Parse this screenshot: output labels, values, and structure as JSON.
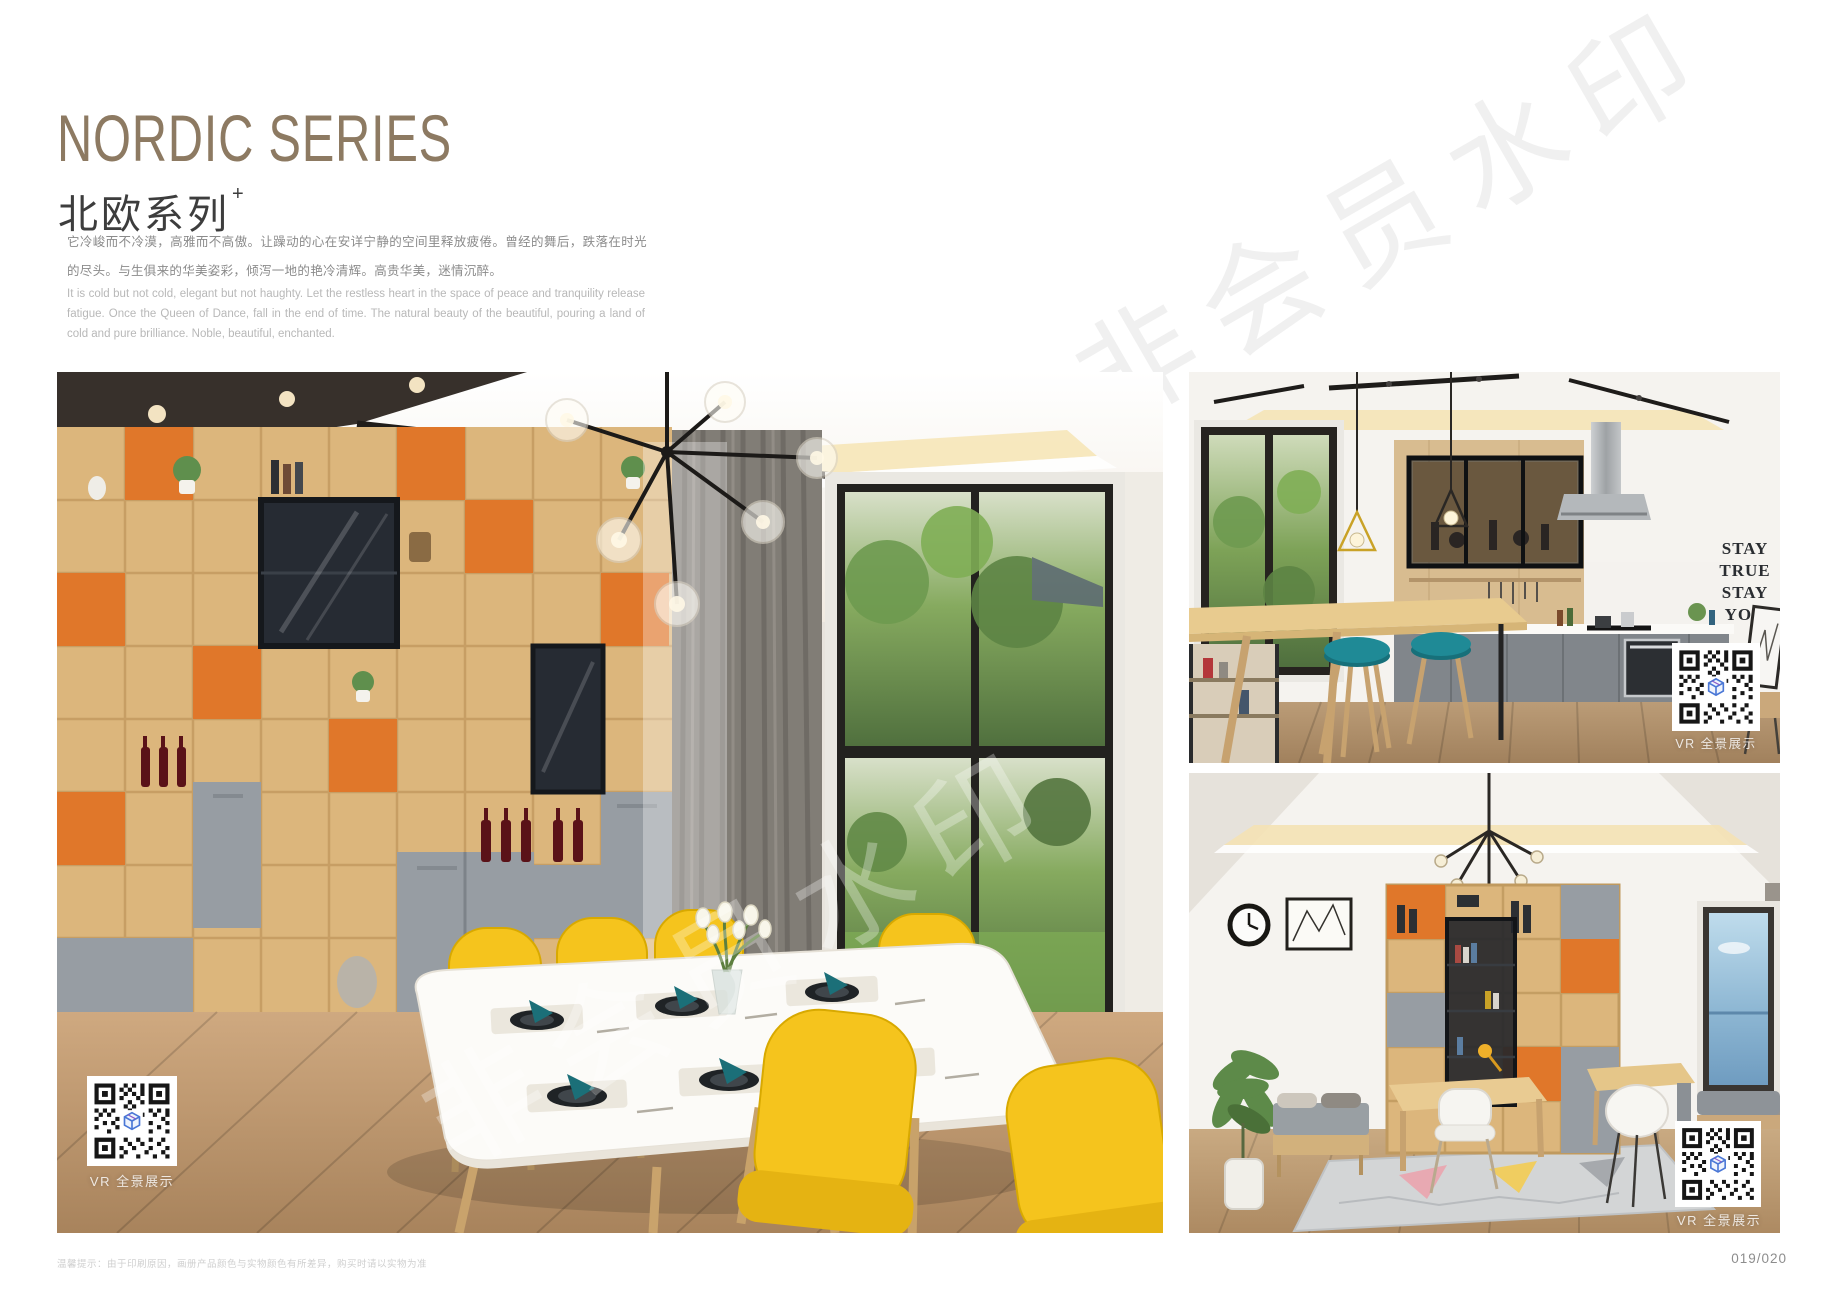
{
  "page": {
    "title_en": "NORDIC SERIES",
    "title_cn": "北欧系列",
    "title_superscript": "+",
    "description_cn": "它冷峻而不冷漠，高雅而不高傲。让躁动的心在安详宁静的空间里释放疲倦。曾经的舞后，跌落在时光的尽头。与生俱来的华美姿彩，倾泻一地的艳冷清辉。高贵华美，迷情沉醉。",
    "description_en": "It is cold but not cold, elegant but not haughty. Let the restless heart in the space of peace and tranquility release fatigue. Once the Queen of Dance, fall in the end of time. The natural beauty of the beautiful, pouring a land of cold and pure brilliance. Noble, beautiful, enchanted.",
    "watermark": "非会员水印",
    "footer_note": "温馨提示：由于印刷原因，画册产品颜色与实物颜色有所差异，购买时请以实物为准",
    "page_number": "019/020"
  },
  "photos": {
    "dining": {
      "name": "dining-room",
      "vr_label": "VR 全景展示"
    },
    "kitchen": {
      "name": "kitchen",
      "vr_label": "VR 全景展示",
      "wall_art": [
        "STAY",
        "TRUE",
        "STAY",
        "YOU"
      ]
    },
    "study": {
      "name": "study-room",
      "vr_label": "VR 全景展示"
    }
  },
  "colors": {
    "title_color": "#8d7a62",
    "accent_orange": "#e0772a",
    "accent_yellow": "#f5c41d",
    "accent_teal": "#1f8a96",
    "wood_light": "#dcb67c",
    "cabinet_gray": "#979da3"
  }
}
